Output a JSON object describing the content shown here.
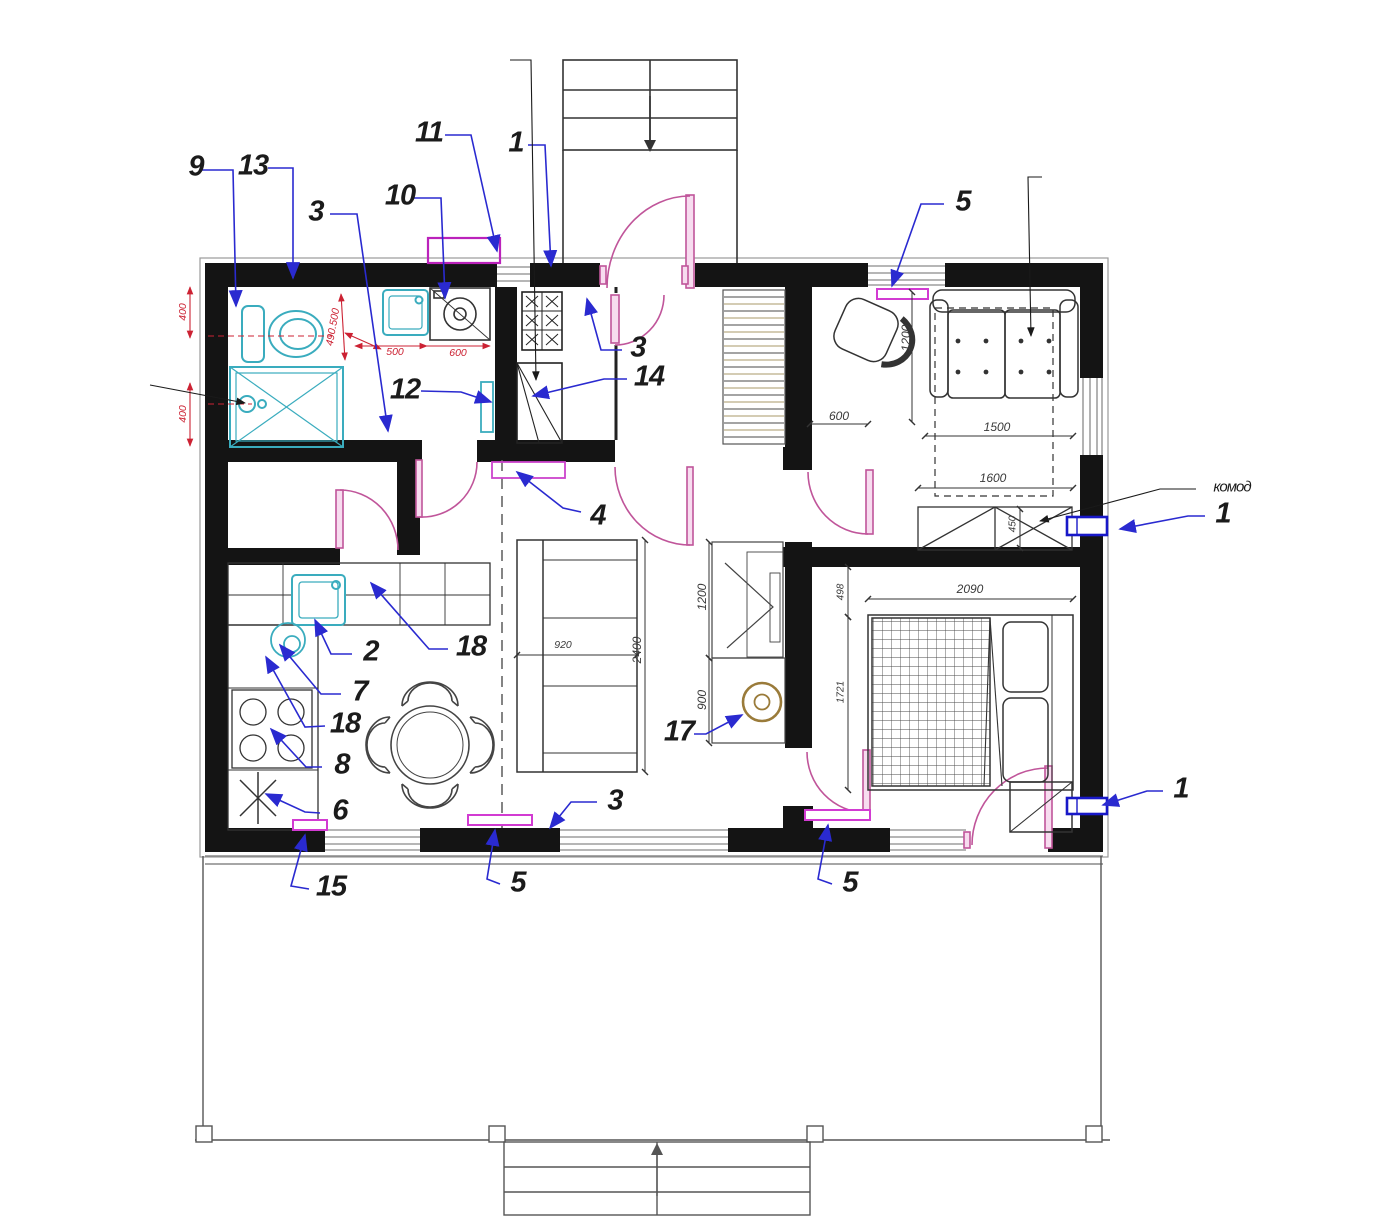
{
  "callouts": {
    "n1": "1",
    "n2": "2",
    "n3": "3",
    "n4": "4",
    "n5": "5",
    "n6": "6",
    "n7": "7",
    "n8": "8",
    "n9": "9",
    "n10": "10",
    "n11": "11",
    "n12": "12",
    "n13": "13",
    "n14": "14",
    "n15": "15",
    "n17": "17",
    "n18": "18",
    "dresser": "комод"
  },
  "dimensions": {
    "red": {
      "d400": "400",
      "d500": "500",
      "d600": "600",
      "d490_500": "490.500"
    },
    "black": {
      "d450": "450",
      "d498": "498",
      "d600": "600",
      "d900": "900",
      "d920": "920",
      "d1200": "1200",
      "d1500": "1500",
      "d1600": "1600",
      "d1721": "1721",
      "d2090": "2090",
      "d2400": "2400"
    }
  },
  "colors": {
    "wall": "#141414",
    "door": "#c0559a",
    "fixture": "#3aacbe",
    "leader": "#2a2ad0",
    "dimension_red": "#cc2233",
    "radiator": "#d23bd2",
    "valve": "#1818c8",
    "heater": "#9a7b3a"
  }
}
